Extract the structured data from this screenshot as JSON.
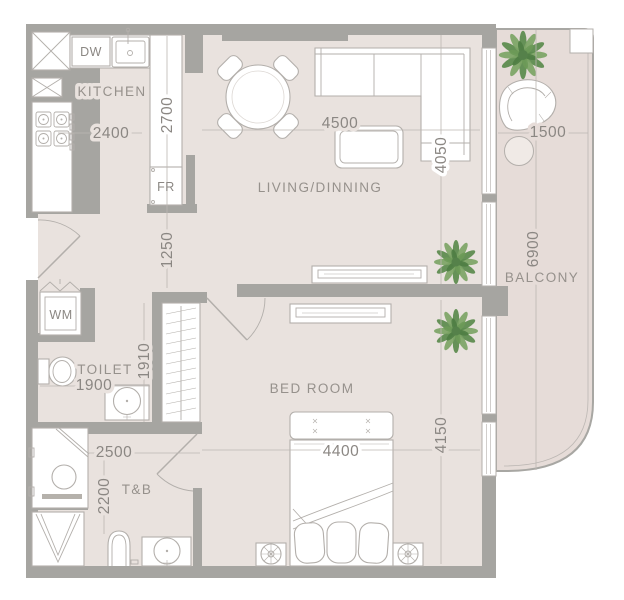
{
  "plan": {
    "rooms": {
      "kitchen": "KITCHEN",
      "living_dining": "LIVING/DINNING",
      "balcony": "BALCONY",
      "toilet": "TOILET",
      "toilet_bath": "T&B",
      "bedroom": "BED ROOM"
    },
    "appliances": {
      "dishwasher": "DW",
      "fridge": "FR",
      "washing_machine": "WM"
    },
    "dimensions_mm": {
      "kitchen_width": "2400",
      "kitchen_length": "2700",
      "hallway_length": "1250",
      "living_width": "4500",
      "living_length": "4050",
      "balcony_width": "1500",
      "balcony_length": "6900",
      "toilet_width": "1900",
      "toilet_length": "1910",
      "tb_width": "2500",
      "tb_length": "2200",
      "bedroom_width": "4400",
      "bedroom_length": "4150"
    },
    "colors": {
      "wall": "#a6a5a1",
      "floor": "#e9e2de",
      "balcony_floor": "#e6dcd8",
      "line": "#b3afab",
      "text": "#8b8783",
      "plant": "#6f9e5d",
      "background": "#ffffff"
    }
  }
}
